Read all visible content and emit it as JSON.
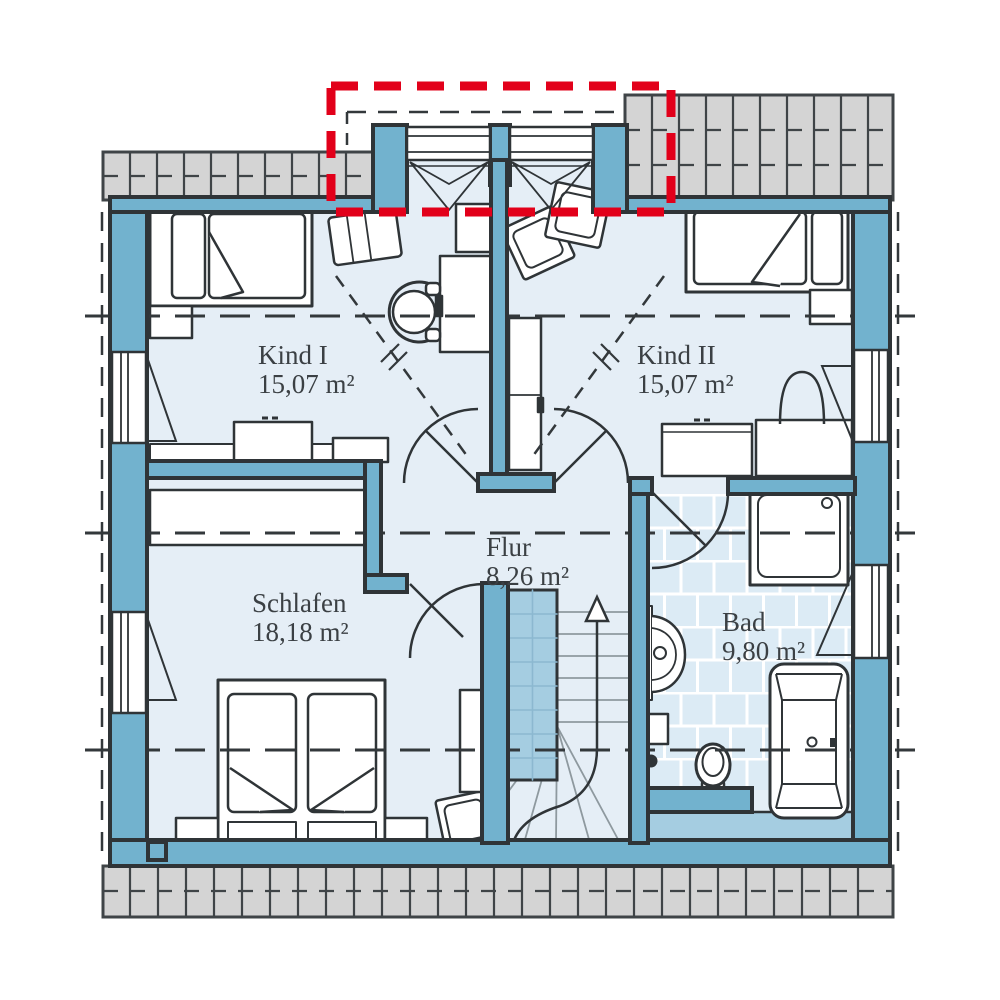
{
  "plan": {
    "type": "floor-plan",
    "floor": "upper-floor",
    "rooms": [
      {
        "name": "Kind I",
        "area": "15,07 m²"
      },
      {
        "name": "Kind II",
        "area": "15,07 m²"
      },
      {
        "name": "Flur",
        "area": "8,26 m²"
      },
      {
        "name": "Schlafen",
        "area": "18,18 m²"
      },
      {
        "name": "Bad",
        "area": "9,80 m²"
      }
    ],
    "highlight": {
      "meaning": "dormer-option-outline",
      "color": "#e2001a"
    },
    "colors": {
      "wall": "#72b2ce",
      "outline": "#2f3437",
      "floor": "#e5eef6",
      "bath_tile": "#dcebf5",
      "stair_void": "#a5cde1",
      "eave_gray": "#d4d4d4"
    },
    "icons": [
      "stairs-up-arrow-icon",
      "slope-arrow-icon"
    ]
  }
}
